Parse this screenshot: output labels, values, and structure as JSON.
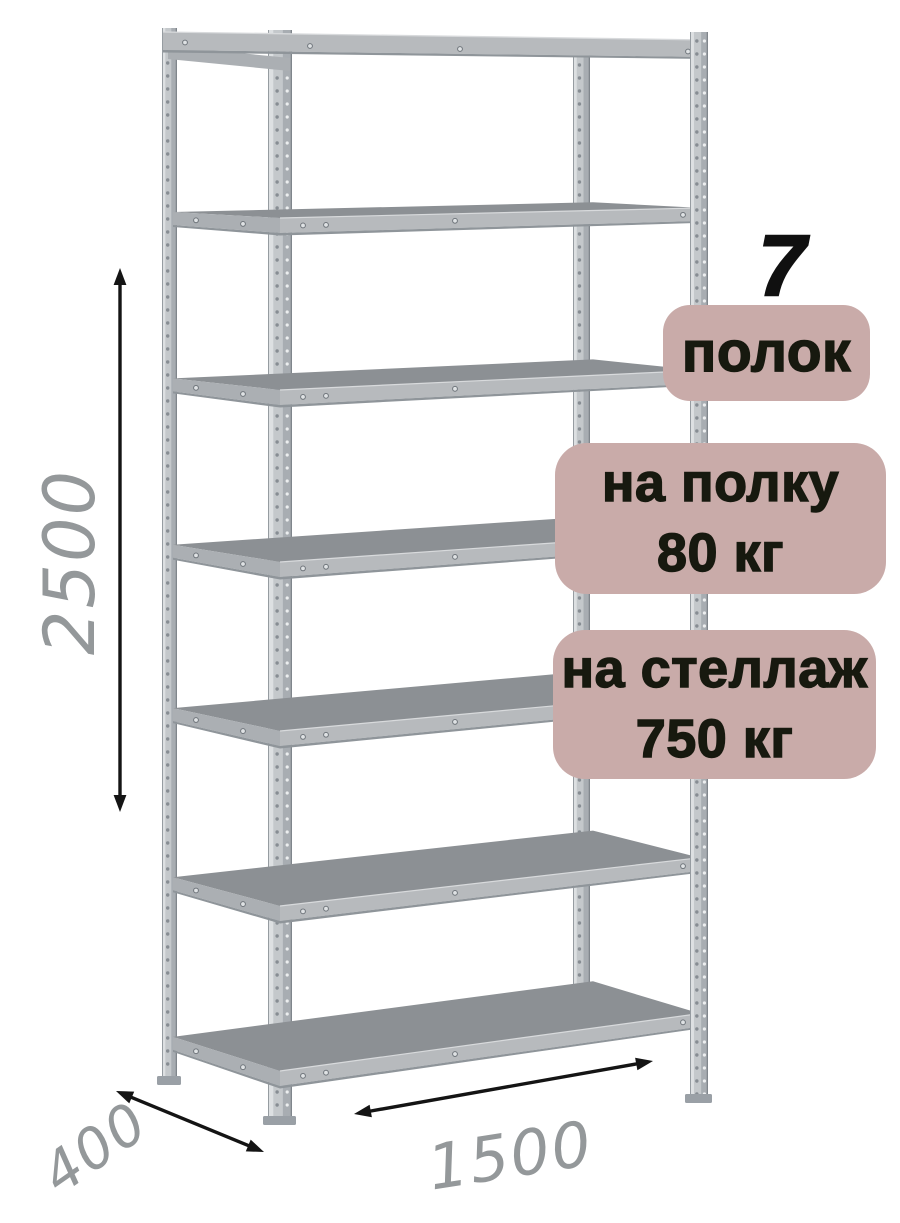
{
  "annotations": {
    "shelf_count_number": "7",
    "shelf_count_label": "полок",
    "shelf_load": {
      "line1": "на полку",
      "line2": "80 кг"
    },
    "rack_load": {
      "line1": "на стеллаж",
      "line2": "750 кг"
    }
  },
  "dimensions": {
    "height": "2500",
    "depth": "400",
    "width": "1500"
  },
  "illustration": {
    "type": "metal-shelving-rack",
    "shelf_count": 7,
    "colors": {
      "badge_bg": "#c9aba9",
      "badge_text": "#17190f",
      "number_text": "#101010",
      "dimension_text": "#94989a",
      "arrow": "#141414",
      "metal_body": "#c4c8cb",
      "metal_highlight": "#dde0e2",
      "metal_shade": "#a8adb2",
      "metal_edge": "#80868c",
      "shelf_surface": "#8c9094",
      "shelf_fascia": "#b7babd",
      "shelf_fascia_dark": "#8f959a",
      "side_fascia": "#abafb3",
      "rivet_fill": "#dfe2e4",
      "rivet_ring": "#6f757b",
      "perforation_dark": "#878d93",
      "perforation_light": "#eceeef",
      "foot": "#9aa0a6"
    }
  }
}
